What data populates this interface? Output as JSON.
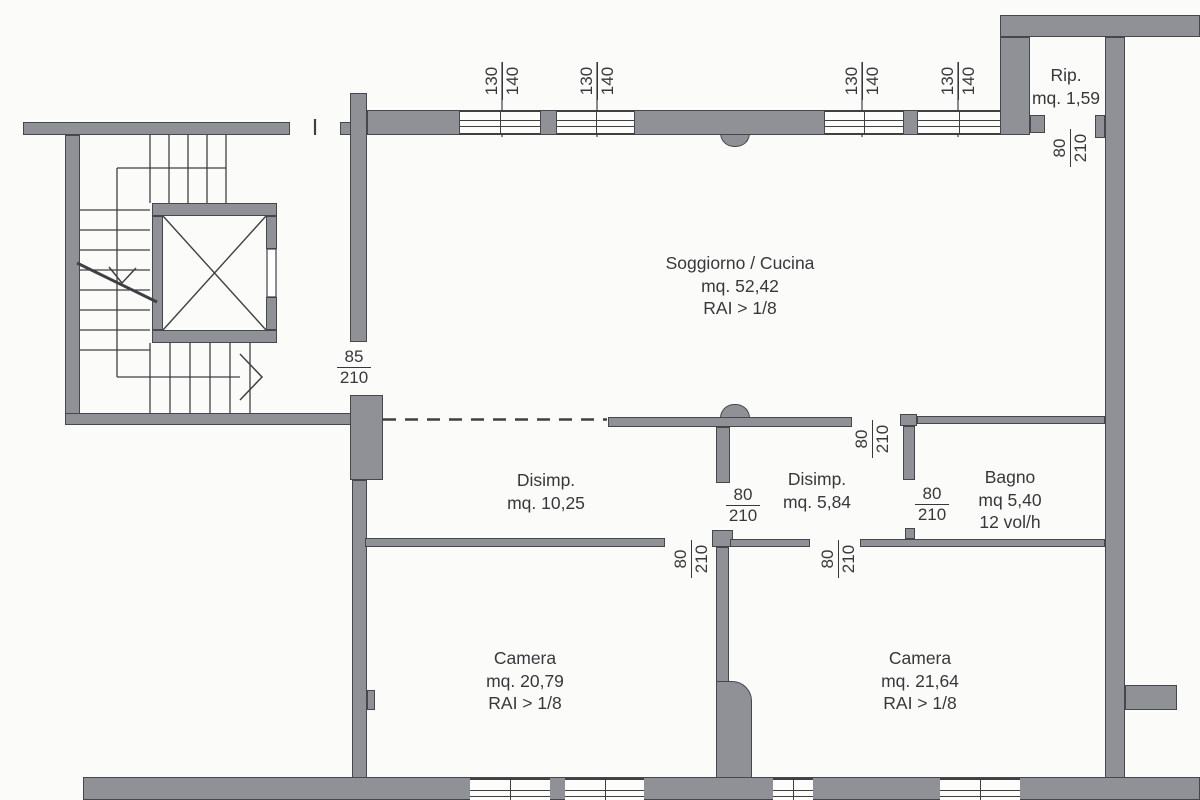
{
  "plan_title": "Apartment floor plan",
  "colors": {
    "wall": "#909196",
    "line": "#3f4044",
    "text": "#37383b",
    "paper": "#fbfbf9"
  },
  "rooms": {
    "soggiorno": {
      "name": "Soggiorno / Cucina",
      "area": "mq. 52,42",
      "note": "RAI > 1/8"
    },
    "rip": {
      "name": "Rip.",
      "area": "mq. 1,59"
    },
    "disimp1": {
      "name": "Disimp.",
      "area": "mq. 10,25"
    },
    "disimp2": {
      "name": "Disimp.",
      "area": "mq. 5,84"
    },
    "bagno": {
      "name": "Bagno",
      "area": "mq 5,40",
      "note": "12 vol/h"
    },
    "camera1": {
      "name": "Camera",
      "area": "mq. 20,79",
      "note": "RAI > 1/8"
    },
    "camera2": {
      "name": "Camera",
      "area": "mq. 21,64",
      "note": "RAI > 1/8"
    }
  },
  "doors": {
    "entry": {
      "width": "85",
      "height": "210"
    },
    "rip": {
      "width": "80",
      "height": "210"
    },
    "disimp2_pass": {
      "width": "80",
      "height": "210"
    },
    "between_disimp": {
      "width": "80",
      "height": "210"
    },
    "bagno": {
      "width": "80",
      "height": "210"
    },
    "camera1": {
      "width": "80",
      "height": "210"
    },
    "camera2": {
      "width": "80",
      "height": "210"
    }
  },
  "windows": {
    "w1": {
      "width": "130",
      "height": "140"
    },
    "w2": {
      "width": "130",
      "height": "140"
    },
    "w3": {
      "width": "130",
      "height": "140"
    },
    "w4": {
      "width": "130",
      "height": "140"
    }
  }
}
